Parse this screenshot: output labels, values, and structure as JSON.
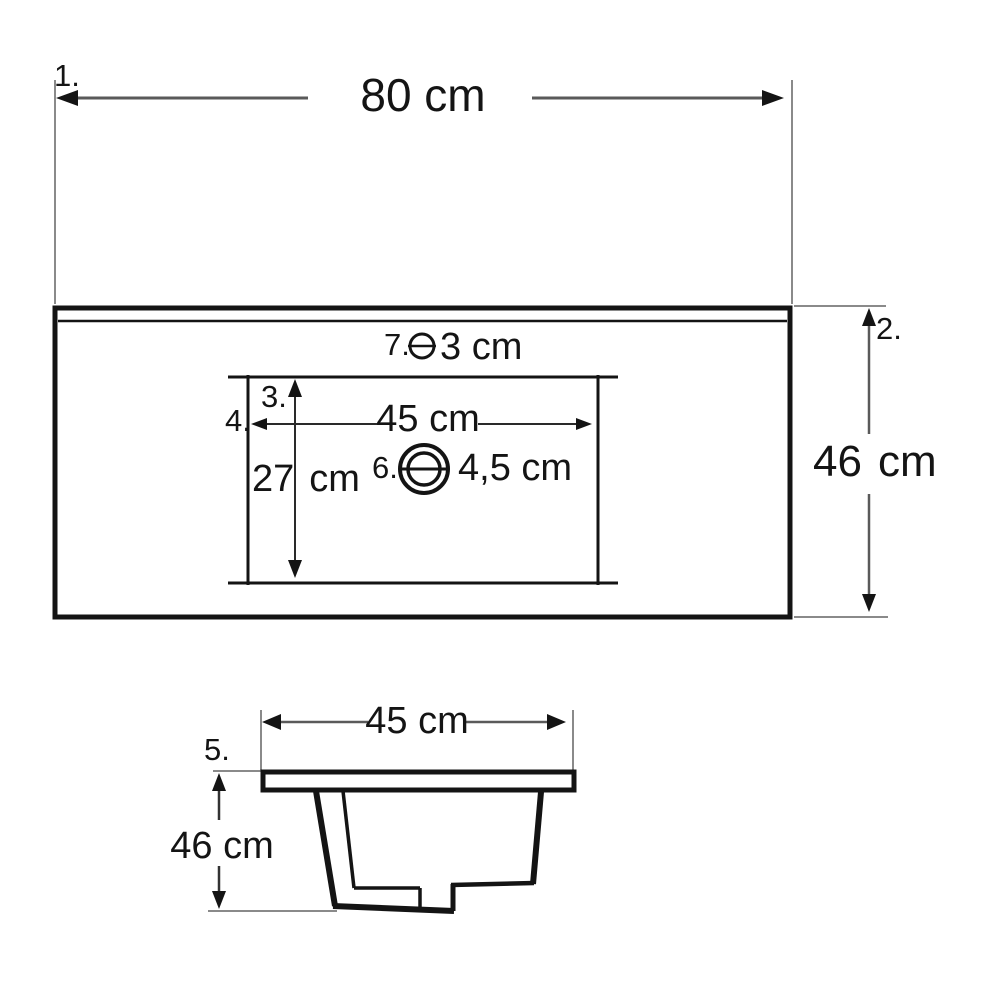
{
  "drawing": {
    "type": "washbasin-technical-drawing",
    "colors": {
      "shape_line": "#141414",
      "dimension_line": "#5a5a5a",
      "extension_line": "#8a8a8a",
      "text": "#141414"
    },
    "top_view": {
      "ref_overall_width": "1.",
      "overall_width": "80 cm",
      "ref_overall_depth": "2.",
      "overall_depth_value": "46",
      "overall_depth_unit": "cm",
      "ref_bowl_depth": "3.",
      "bowl_depth_value": "27",
      "bowl_depth_unit": "cm",
      "ref_bowl_width": "4.",
      "bowl_width": "45 cm",
      "ref_drain": "6.",
      "drain_diameter": "4,5 cm",
      "ref_overflow": "7.",
      "overflow_diameter": "3 cm"
    },
    "side_view": {
      "ref_top_width": "5.",
      "top_width": "45 cm",
      "height": "46 cm"
    }
  }
}
